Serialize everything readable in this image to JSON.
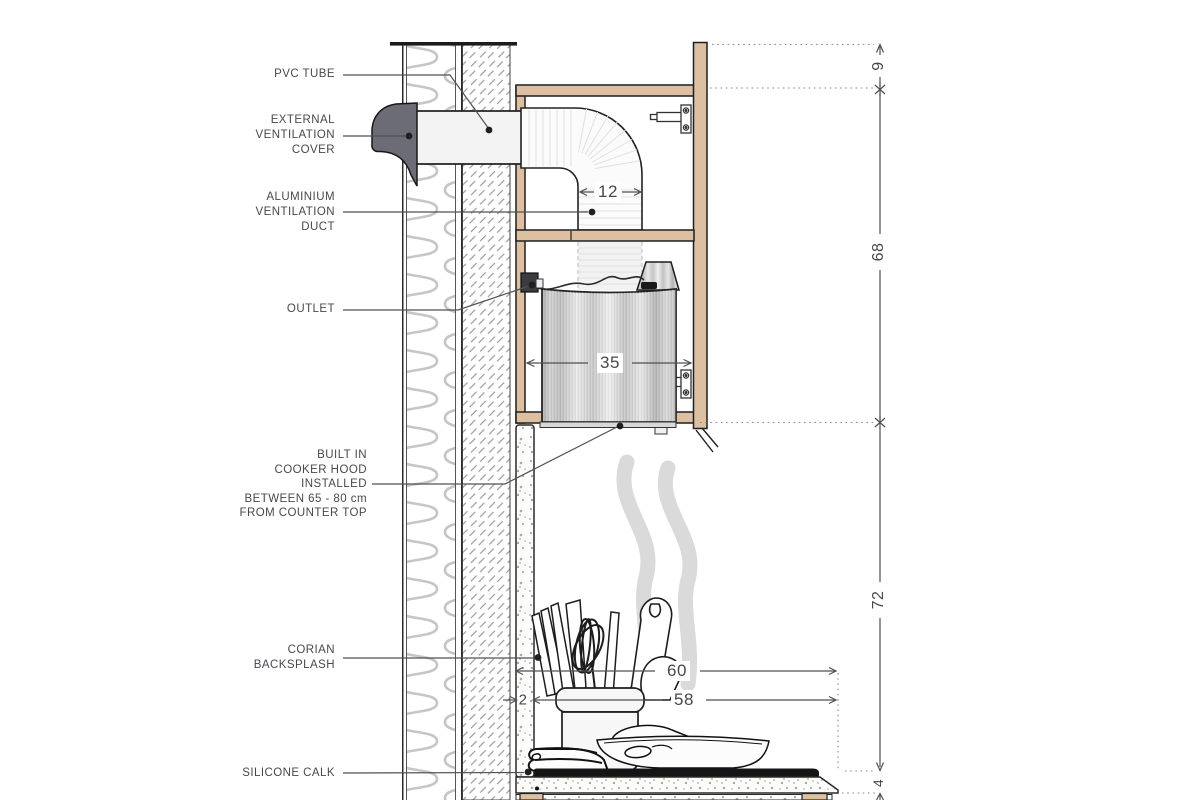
{
  "drawing": {
    "subject": "Built-in cooker hood ventilation section detail"
  },
  "labels": {
    "pvc_tube": "PVC TUBE",
    "external_ventilation_cover": "EXTERNAL\nVENTILATION\nCOVER",
    "aluminium_ventilation_duct": "ALUMINIUM\nVENTILATION\nDUCT",
    "outlet": "OUTLET",
    "built_in_cooker_hood": "BUILT IN\nCOOKER HOOD\nINSTALLED\nBETWEEN 65 - 80 cm\nFROM COUNTER TOP",
    "corian_backsplash": "CORIAN\nBACKSPLASH",
    "silicone_calk": "SILICONE CALK"
  },
  "dimensions": {
    "duct_width": "12",
    "hood_width": "35",
    "counter_depth": "60",
    "hob_depth": "58",
    "backsplash_thickness": "2",
    "top_gap": "9",
    "upper_cabinet_height": "68",
    "hood_to_counter": "72",
    "counter_thickness": "4"
  },
  "colors": {
    "wood": "#dcc0a1",
    "outline": "#1f1f1f",
    "external_cover_gray": "#6c6c76",
    "steam_gray": "#d7d7d7",
    "label_text": "#47494e",
    "leader_line": "#4e5054",
    "hob_black": "#151515"
  }
}
